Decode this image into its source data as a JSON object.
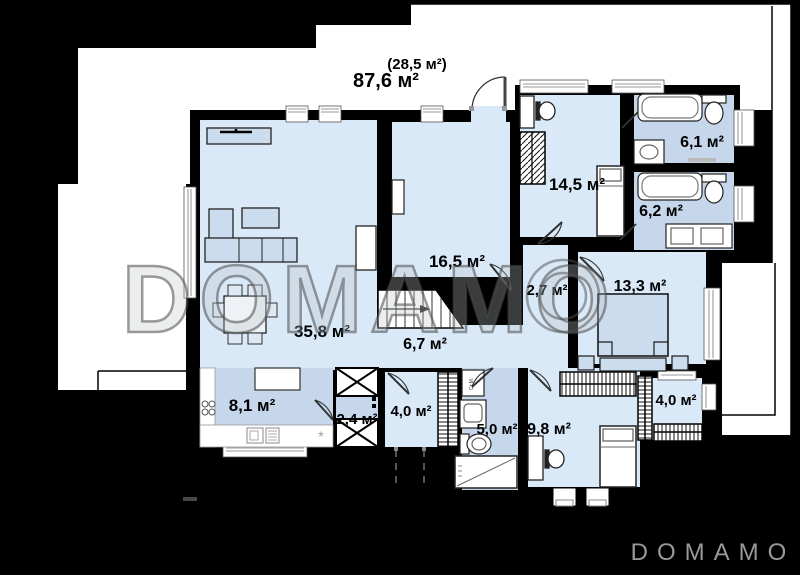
{
  "header": {
    "terrace_area": "(28,5 м²)",
    "total_area": "87,6 м²"
  },
  "rooms": [
    {
      "name": "living-dining",
      "area": "35,8 м²"
    },
    {
      "name": "kitchen",
      "area": "8,1 м²"
    },
    {
      "name": "pantry",
      "area": "2,4 м²"
    },
    {
      "name": "wardrobe-left",
      "area": "4,0 м²"
    },
    {
      "name": "bathroom-small",
      "area": "5,0 м²"
    },
    {
      "name": "bedroom-9-8",
      "area": "9,8 м²"
    },
    {
      "name": "wardrobe-right",
      "area": "4,0 м²"
    },
    {
      "name": "bedroom-13-3",
      "area": "13,3 м²"
    },
    {
      "name": "hall",
      "area": "2,7 м²"
    },
    {
      "name": "corridor",
      "area": "6,7 м²"
    },
    {
      "name": "room-16-5",
      "area": "16,5 м²"
    },
    {
      "name": "bedroom-14-5",
      "area": "14,5 м²"
    },
    {
      "name": "bathroom-6-1",
      "area": "6,1 м²"
    },
    {
      "name": "bathroom-6-2",
      "area": "6,2 м²"
    }
  ],
  "fixtures": {
    "washing_machine": "Ст.М."
  },
  "watermark": {
    "center_text": "DOMAMO",
    "logo_text": "DOMAMO"
  },
  "colors": {
    "background": "#000000",
    "room_light": "#d9e9f8",
    "room_medium": "#c6d7ec",
    "outdoor": "#ffffff",
    "watermark_gray": "#999999"
  }
}
